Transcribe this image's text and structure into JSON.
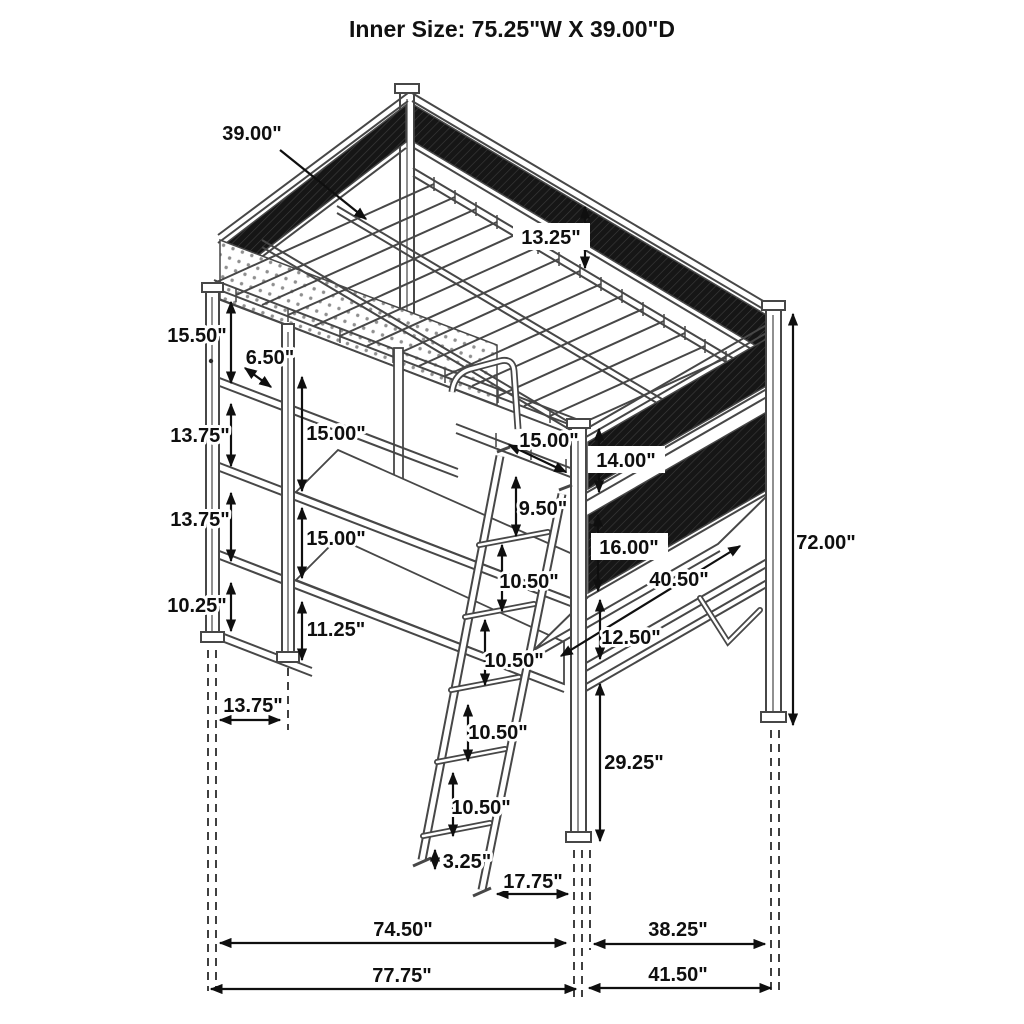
{
  "title": "Inner Size: 75.25\"W X 39.00\"D",
  "drawing": {
    "subject": "loft-bed-with-desk-and-shelves-dimension-diagram",
    "colors": {
      "background": "#ffffff",
      "structure_line": "#474747",
      "dimension_line": "#0f0f0f",
      "mesh_panel": "#161616",
      "label_text": "#0f0f0f"
    }
  },
  "dimensions": [
    {
      "id": "mattress-slat-depth",
      "text": "39.00\""
    },
    {
      "id": "guard-rail-height",
      "text": "13.25\""
    },
    {
      "id": "shelf-gap-top",
      "text": "15.50\""
    },
    {
      "id": "top-shelf-depth",
      "text": "6.50\""
    },
    {
      "id": "shelf-gap-middle",
      "text": "13.75\""
    },
    {
      "id": "left-clearance-upper",
      "text": "15.00\""
    },
    {
      "id": "shelf-gap-lower",
      "text": "13.75\""
    },
    {
      "id": "left-clearance-lower",
      "text": "15.00\""
    },
    {
      "id": "shelf-gap-bottom",
      "text": "10.25\""
    },
    {
      "id": "inner-post-bottom",
      "text": "11.25\""
    },
    {
      "id": "shelf-unit-depth",
      "text": "13.75\""
    },
    {
      "id": "front-rail-length",
      "text": "15.00\""
    },
    {
      "id": "mesh-gap-height",
      "text": "14.00\""
    },
    {
      "id": "ladder-top-spacing",
      "text": "9.50\""
    },
    {
      "id": "mesh-panel-height",
      "text": "16.00\""
    },
    {
      "id": "ladder-rung-spacing-1",
      "text": "10.50\""
    },
    {
      "id": "desk-surface-width",
      "text": "40.50\""
    },
    {
      "id": "desk-rail-gap",
      "text": "12.50\""
    },
    {
      "id": "ladder-rung-spacing-2",
      "text": "10.50\""
    },
    {
      "id": "ladder-rung-spacing-3",
      "text": "10.50\""
    },
    {
      "id": "desk-height-from-floor",
      "text": "29.25\""
    },
    {
      "id": "ladder-rung-spacing-4",
      "text": "10.50\""
    },
    {
      "id": "ladder-foot-height",
      "text": "3.25\""
    },
    {
      "id": "ladder-foot-offset",
      "text": "17.75\""
    },
    {
      "id": "bed-length-inner",
      "text": "74.50\""
    },
    {
      "id": "end-width-inner",
      "text": "38.25\""
    },
    {
      "id": "bed-length-overall",
      "text": "77.75\""
    },
    {
      "id": "end-width-overall",
      "text": "41.50\""
    },
    {
      "id": "overall-height",
      "text": "72.00\""
    }
  ]
}
